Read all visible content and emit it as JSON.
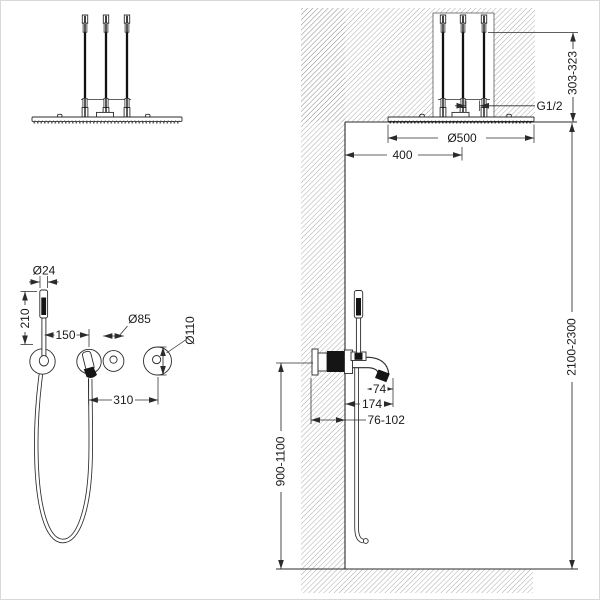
{
  "dimensions": {
    "head_height_range": "303-323",
    "inlet_thread": "G1/2",
    "head_diameter": "Ø500",
    "head_center_offset": "400",
    "install_height_range": "2100-2300",
    "mixer_height_range": "900-1100",
    "spout_offset": "74",
    "spout_projection": "174",
    "embed_depth_range": "76-102",
    "handshower_diameter": "Ø24",
    "handshower_length": "210",
    "holder_to_spout": "150",
    "trim_diameter": "Ø85",
    "mixer_trim_diameter": "Ø110",
    "spout_to_mixer": "310"
  }
}
